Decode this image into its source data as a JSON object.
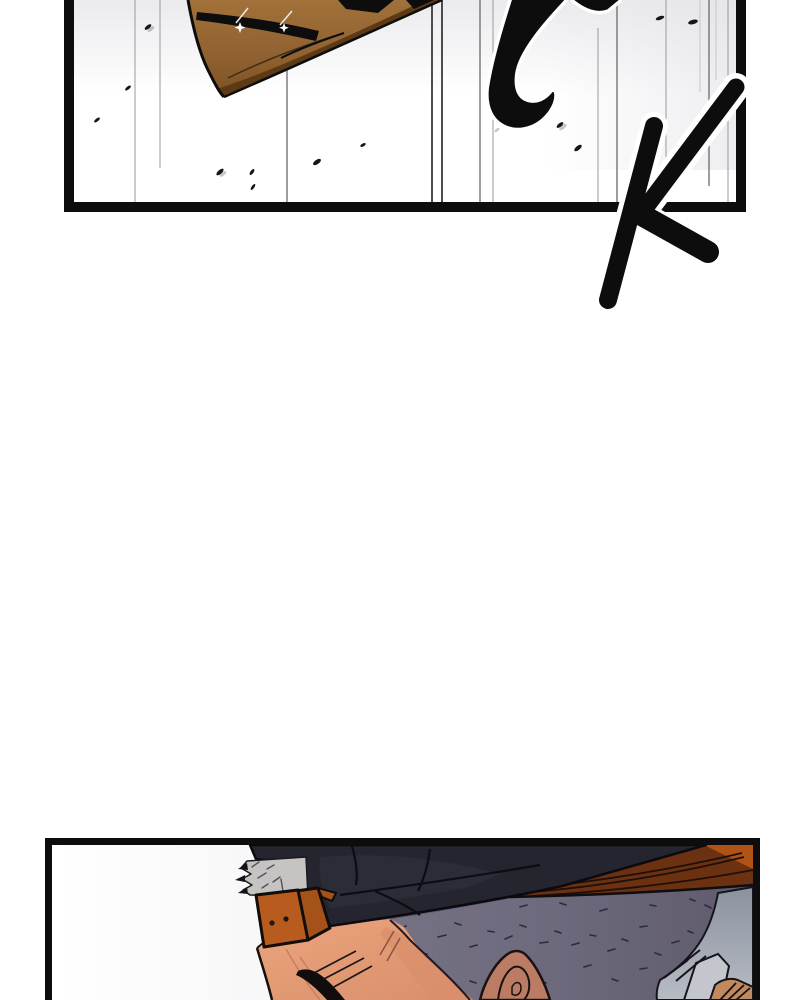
{
  "page": {
    "width": 800,
    "height": 1000,
    "background": "#ffffff",
    "kind": "webtoon comic segment"
  },
  "sfx": {
    "text": "CK"
  },
  "panels": [
    {
      "id": "panel-impact",
      "label": "broken wooden blade flying past vertical speed lines with scattered debris; brush sound-effect CK overlapping the frame"
    },
    {
      "id": "panel-closeup",
      "label": "close-up of a stubble-headed man in a dark cap with an orange strap, gray hair tuft, head bowed"
    }
  ],
  "palette": {
    "ink": "#0d0d0d",
    "paper": "#ffffff",
    "wood": "#8f6130",
    "wood_dark": "#5e3a14",
    "cap_navy": "#24252f",
    "brim_orange": "#b05317",
    "brim_brown": "#6b3110",
    "strap_orange": "#b75c1e",
    "skin": "#eba57d",
    "skin_shadow": "#d88e6b",
    "stubble_gray": "#6e6a7d",
    "hair_gray": "#c6c4c3",
    "collar_gray": "#949aa6"
  }
}
